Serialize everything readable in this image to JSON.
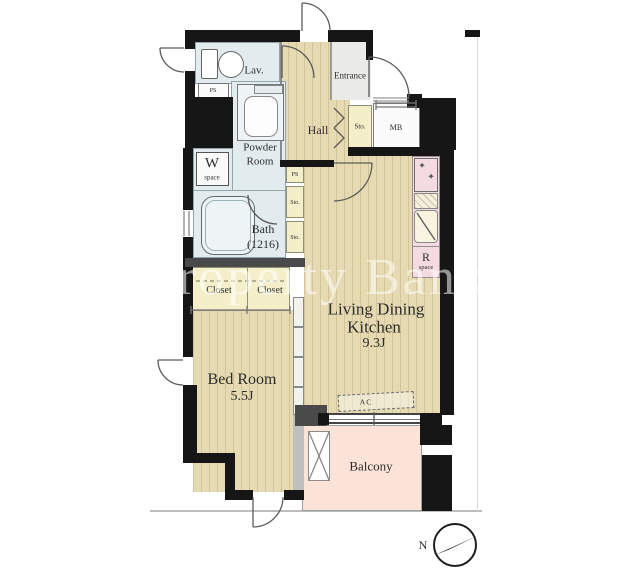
{
  "rooms": {
    "lav": {
      "label": "Lav."
    },
    "powder": {
      "line1": "Powder",
      "line2": "Room"
    },
    "bath": {
      "line1": "Bath",
      "line2": "(1216)"
    },
    "hall": {
      "label": "Hall"
    },
    "entrance": {
      "label": "Entrance"
    },
    "hall_storage": {
      "label": "Sto."
    },
    "meter_box": {
      "label": "MB"
    },
    "washer_space": {
      "letter": "W",
      "word": "space"
    },
    "pipe_space_top": {
      "label": "PS"
    },
    "pipe_space_mid": {
      "label": "PS"
    },
    "storage_upper": {
      "label": "Sto."
    },
    "storage_lower": {
      "label": "Sto."
    },
    "closet_left": {
      "label": "Closet"
    },
    "closet_right": {
      "label": "Closet"
    },
    "ldk": {
      "line1": "Living Dining",
      "line2": "Kitchen",
      "size": "9.3J"
    },
    "bedroom": {
      "line1": "Bed Room",
      "size": "5.5J"
    },
    "fridge_space": {
      "letter": "R",
      "word": "space"
    },
    "balcony": {
      "label": "Balcony"
    },
    "ac": {
      "label": "AC"
    }
  },
  "icons": {
    "burner_glyph": "✦"
  },
  "compass": {
    "label": "N"
  },
  "watermark": {
    "text": "Property Bank"
  },
  "colors": {
    "wall": "#161616",
    "wood_floor": "#e6dab2",
    "wet_area_blue": "#e2ebee",
    "storage_yellow": "#f4efc9",
    "kitchen_pink": "#f3dbe1",
    "balcony_pink": "#fbe4d7",
    "entrance_gray": "#eaeae8"
  }
}
